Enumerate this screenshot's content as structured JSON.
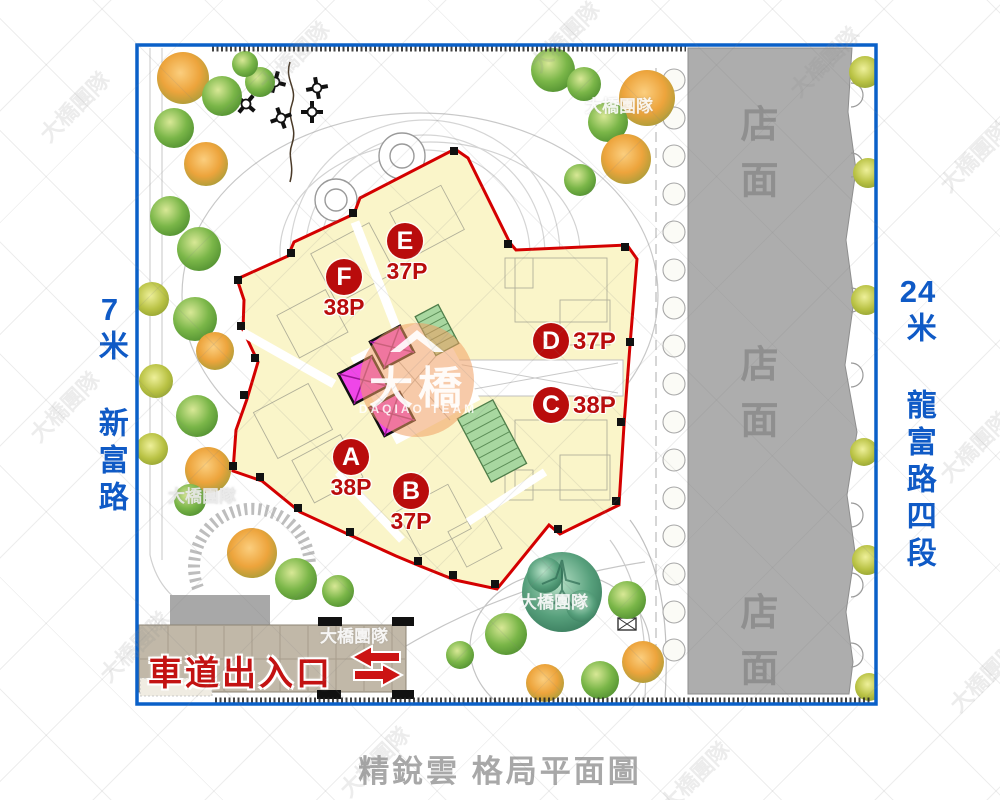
{
  "caption": "精銳雲 格局平面圖",
  "roads": {
    "left": {
      "width": "7",
      "name": "米 新富路"
    },
    "right": {
      "width": "24",
      "name": "米 龍富路四段"
    }
  },
  "shop_label": "店面",
  "driveway_label": "車道出入口",
  "units": [
    {
      "letter": "A",
      "area": "38P"
    },
    {
      "letter": "B",
      "area": "37P"
    },
    {
      "letter": "C",
      "area": "38P"
    },
    {
      "letter": "D",
      "area": "37P"
    },
    {
      "letter": "E",
      "area": "37P"
    },
    {
      "letter": "F",
      "area": "38P"
    }
  ],
  "watermark": {
    "team": "大橋團隊",
    "brand": "大橋",
    "brand_sub": "DAQIAO TEAM"
  },
  "colors": {
    "frame_blue": "#0a60c8",
    "road_blue": "#0f5ac6",
    "unit_red": "#b90c0c",
    "building_cream": "#faf5c9",
    "boundary_red": "#d40000",
    "shop_gray": "#adadad",
    "elevator_magenta": "#ef46e8",
    "stair_green": "#a8d7a0",
    "driveway_tan": "#c1b8a8"
  }
}
